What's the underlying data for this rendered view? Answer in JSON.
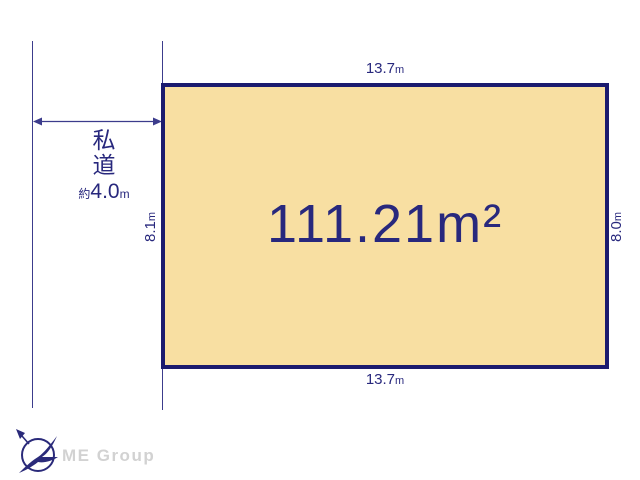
{
  "plot": {
    "area_text": "111.21m²",
    "fill_color": "#f8dfa2",
    "border_color": "#1b1b6f"
  },
  "road": {
    "label_char1": "私",
    "label_char2": "道",
    "width_prefix": "約",
    "width_value": "4.0",
    "width_unit": "m"
  },
  "dimensions": {
    "top": {
      "value": "13.7",
      "unit": "m"
    },
    "bottom": {
      "value": "13.7",
      "unit": "m"
    },
    "left": {
      "value": "8.1",
      "unit": "m"
    },
    "right": {
      "value": "8.0",
      "unit": "m"
    }
  },
  "footer": {
    "brand": "ME Group"
  },
  "icons": {
    "compass": "compass-north-bird-icon",
    "road_arrow": "double-arrow-icon"
  },
  "colors": {
    "text_navy": "#28287d",
    "line_navy": "#3c3c8c",
    "brand_gray": "#d2d2d2"
  }
}
